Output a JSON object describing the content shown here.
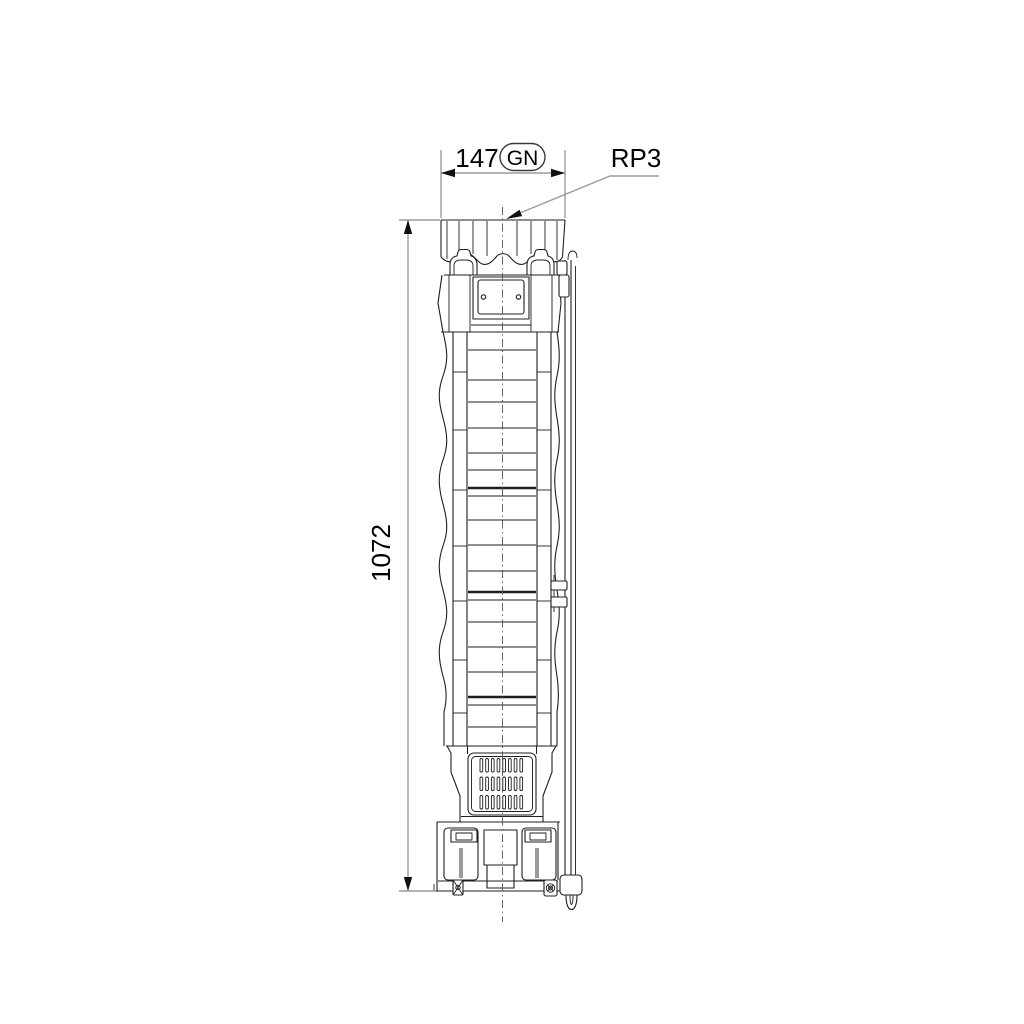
{
  "dimensions": {
    "width": {
      "value": "147",
      "tag": "GN"
    },
    "height": {
      "value": "1072"
    },
    "connection": {
      "label": "RP3"
    }
  },
  "colors": {
    "outline": "#1f1f1f",
    "dimension_line": "#9c9c9c",
    "arrowhead": "#111111",
    "text": "#000000",
    "background": "#ffffff"
  }
}
